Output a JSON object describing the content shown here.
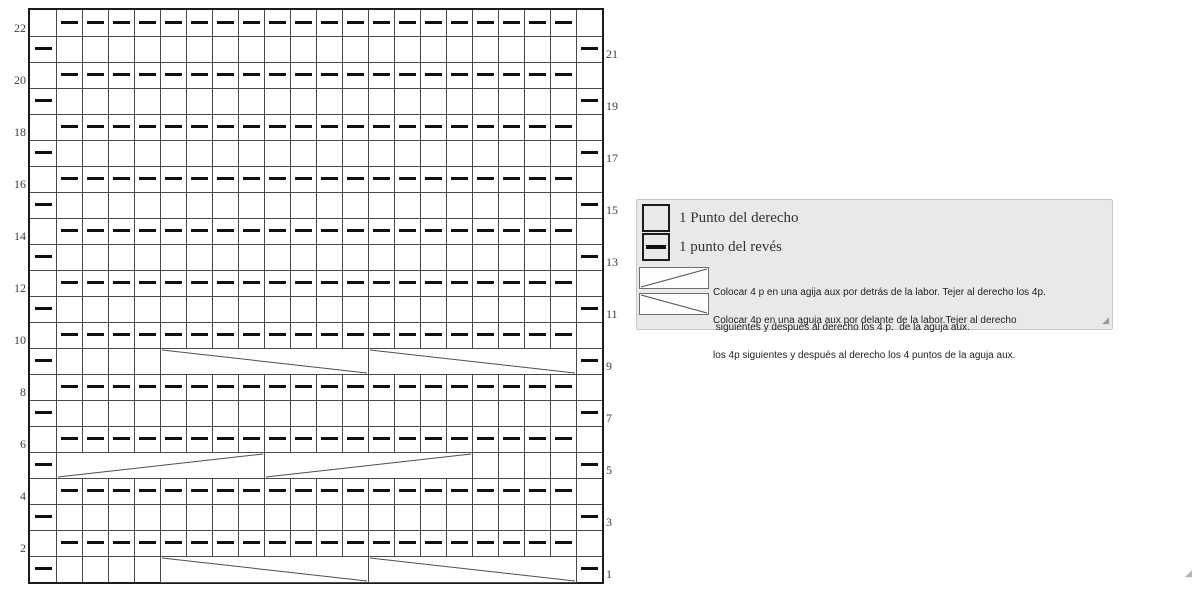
{
  "chart_data": {
    "type": "knitting-chart",
    "rows": 22,
    "cols": 22,
    "cell_px": 26,
    "left_row_labels": [
      22,
      20,
      18,
      16,
      14,
      12,
      10,
      8,
      6,
      4,
      2
    ],
    "right_row_labels": [
      21,
      19,
      17,
      15,
      13,
      11,
      9,
      7,
      5,
      3,
      1
    ],
    "purl_full_rows": [
      22,
      20,
      18,
      16,
      14,
      12,
      10,
      8,
      6,
      4,
      2
    ],
    "purl_full_rows_col_range": {
      "from": 2,
      "to": 21
    },
    "edge_purl_rows": [
      21,
      19,
      17,
      15,
      13,
      11,
      9,
      7,
      5,
      3,
      1
    ],
    "edge_purl_cols": [
      1,
      22
    ],
    "cables": [
      {
        "row": 9,
        "col": 6,
        "span": 8,
        "cross": "front"
      },
      {
        "row": 9,
        "col": 14,
        "span": 8,
        "cross": "front"
      },
      {
        "row": 5,
        "col": 2,
        "span": 8,
        "cross": "back"
      },
      {
        "row": 5,
        "col": 10,
        "span": 8,
        "cross": "back"
      },
      {
        "row": 1,
        "col": 6,
        "span": 8,
        "cross": "front"
      },
      {
        "row": 1,
        "col": 14,
        "span": 8,
        "cross": "front"
      }
    ],
    "cross_legend": {
      "back": "diagonal-rising",
      "front": "diagonal-falling"
    }
  },
  "legend": {
    "item_knit": {
      "label": "1 Punto del derecho"
    },
    "item_purl": {
      "label": "1 punto del revés"
    },
    "item_cable_back": {
      "line1": "Colocar 4 p en una agija aux por detrás de la labor. Tejer al derecho los 4p.",
      "line2": " siguientes y después al derecho los 4 p.  de la aguja aux."
    },
    "item_cable_front": {
      "line1": "Colocar 4p en una aguja aux por delante de la labor.Tejer al derecho",
      "line2": "los 4p siguientes y después al derecho los 4 puntos de la aguja aux."
    }
  },
  "icons": {
    "legend_resize_grip": "◢",
    "page_resize_grip": "◢"
  },
  "colors": {
    "grid_line": "#4a4a4a",
    "grid_border": "#1c1c1c",
    "stitch_dash": "#0f0f0f",
    "cable_stroke": "#4f4f4f",
    "legend_bg": "#e9e9e9",
    "legend_border": "#c6c6c6"
  }
}
